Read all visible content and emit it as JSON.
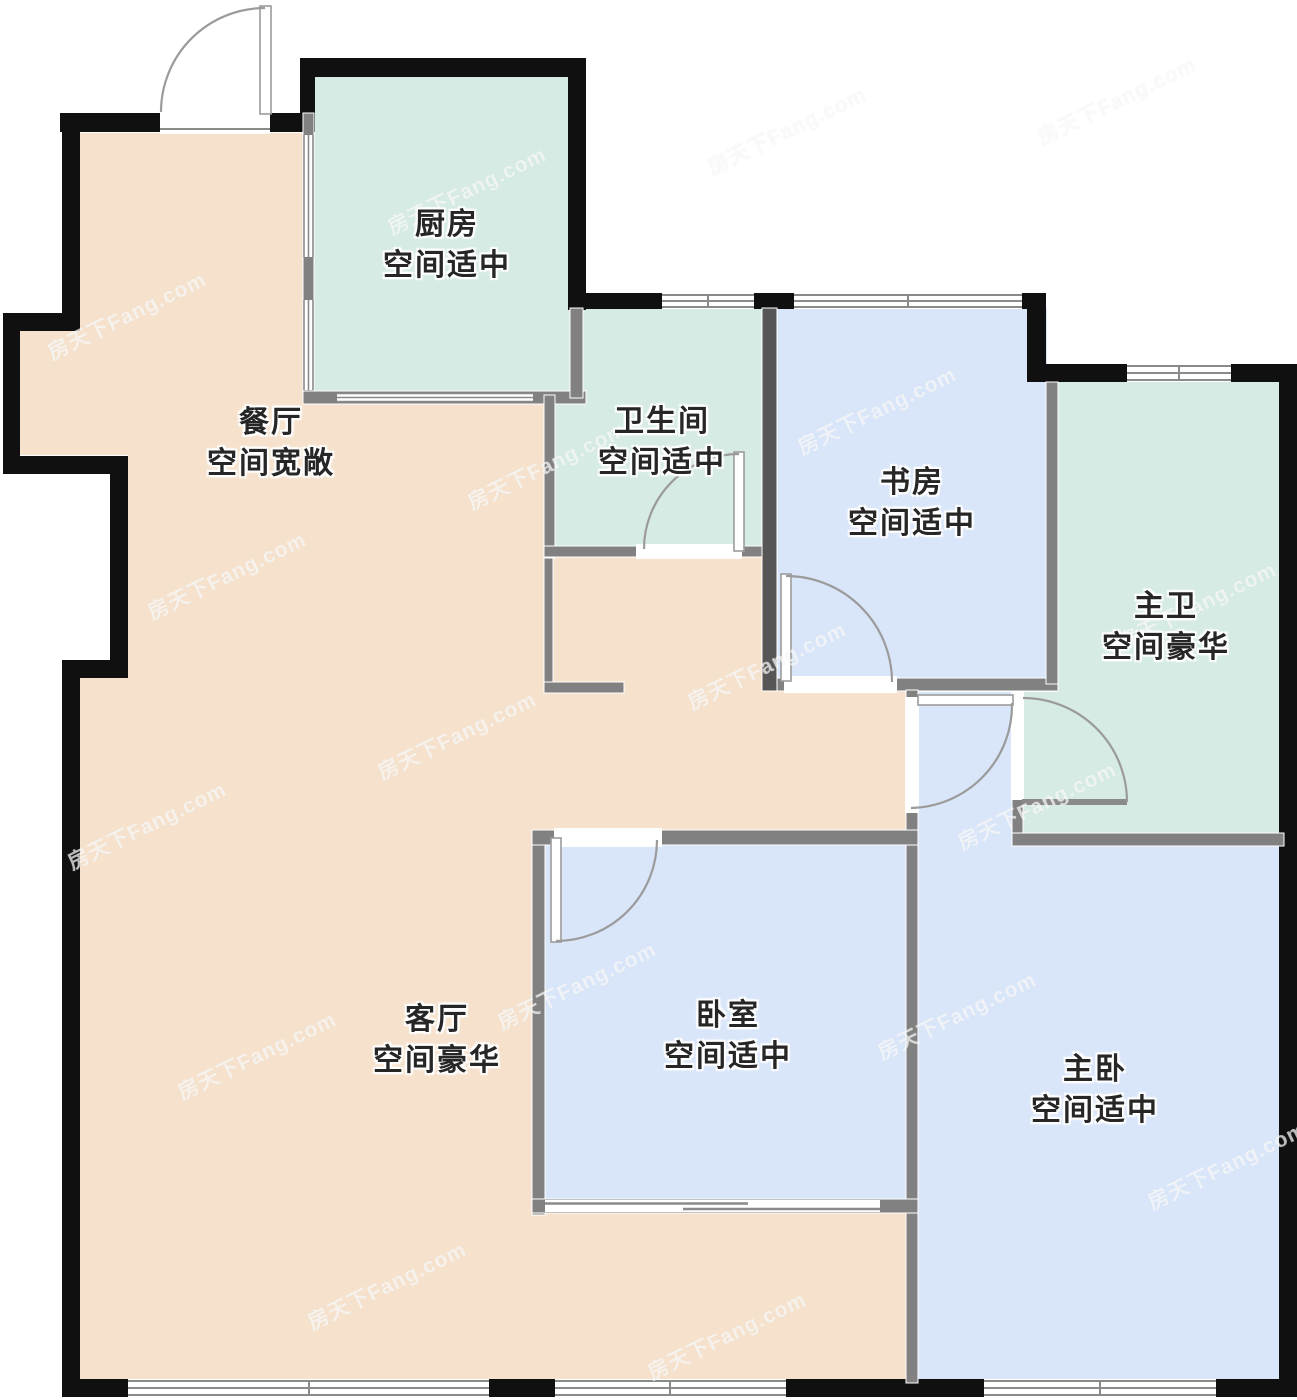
{
  "watermark": {
    "text": "房天下Fang.com"
  },
  "rooms": [
    {
      "id": "kitchen",
      "name": "厨房",
      "note": "空间适中"
    },
    {
      "id": "dining",
      "name": "餐厅",
      "note": "空间宽敞"
    },
    {
      "id": "bathroom",
      "name": "卫生间",
      "note": "空间适中"
    },
    {
      "id": "study",
      "name": "书房",
      "note": "空间适中"
    },
    {
      "id": "master-bathroom",
      "name": "主卫",
      "note": "空间豪华"
    },
    {
      "id": "living",
      "name": "客厅",
      "note": "空间豪华"
    },
    {
      "id": "bedroom",
      "name": "卧室",
      "note": "空间适中"
    },
    {
      "id": "master-bedroom",
      "name": "主卧",
      "note": "空间适中"
    }
  ],
  "colors": {
    "wall": "#101010",
    "interior_wall": "#818181",
    "interior_wall_dark": "#565656",
    "dining_living": "#f6e2cc",
    "kitchen_bath": "#d5ebe3",
    "bedroom_blue": "#d9e6fa",
    "door_arc": "#9b9b9b",
    "window_line": "#8a8a8a"
  }
}
